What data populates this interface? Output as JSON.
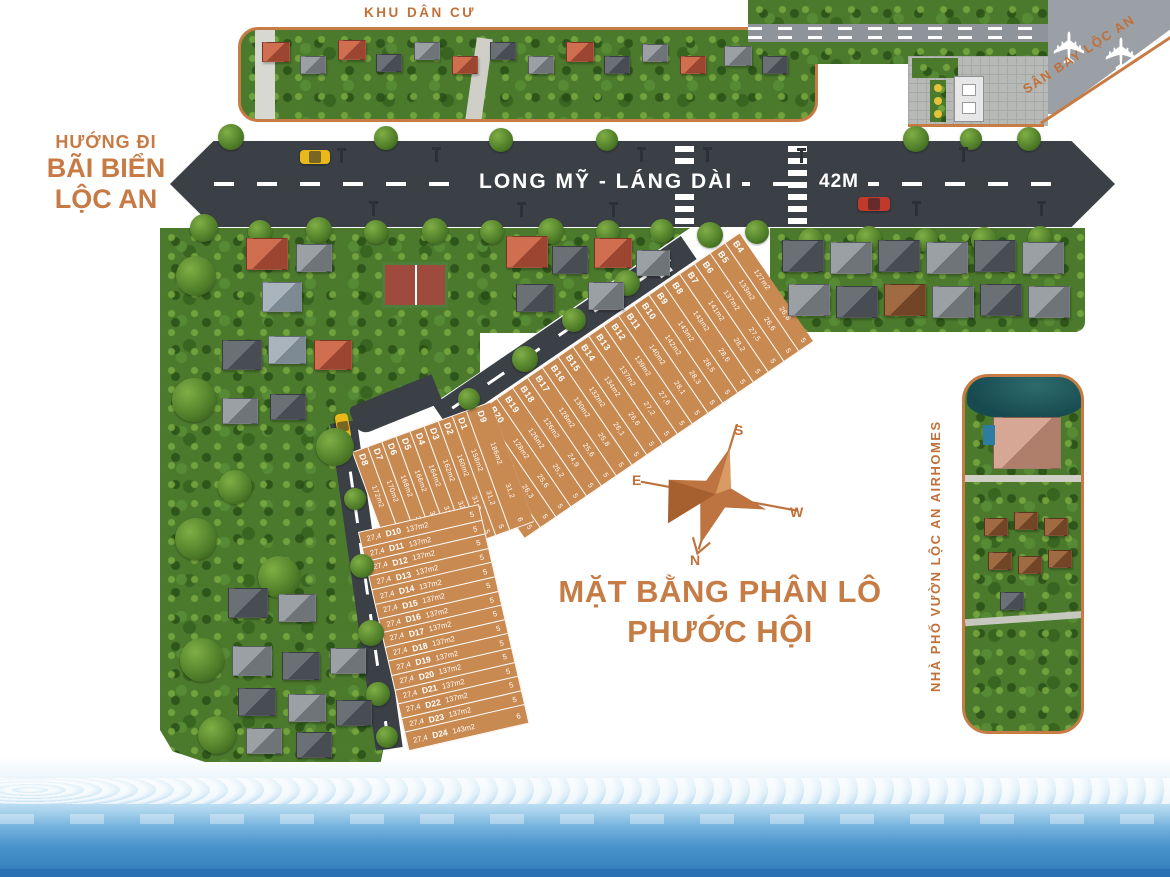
{
  "title": {
    "line1": "MẶT BẰNG PHÂN LÔ",
    "line2": "PHƯỚC HỘI"
  },
  "labels": {
    "residential_area": "KHU DÂN CƯ",
    "direction_line1": "HƯỚNG ĐI",
    "direction_line2": "BÃI BIỂN",
    "direction_line3": "LỘC AN",
    "main_road_name": "LONG MỸ - LÁNG DÀI",
    "main_road_width": "42M",
    "airport": "SÂN BAY LỘC AN",
    "airhomes_panel": "NHÀ PHỐ VƯỜN LỘC AN AIRHOMES"
  },
  "compass": {
    "north": "N",
    "south": "S",
    "east": "E",
    "west": "W"
  },
  "colors": {
    "accent_orange": "#c67c44",
    "plot_fill": "#c98a52",
    "road_gray": "#3b4046",
    "land_green": "#4c7a2d",
    "ocean_blue": "#3a86c1"
  },
  "plots": {
    "b_series": [
      {
        "id": "B4",
        "area": "127m2",
        "depth": "26,8",
        "width": "5"
      },
      {
        "id": "B5",
        "area": "133m2",
        "depth": "26,6",
        "width": "5"
      },
      {
        "id": "B6",
        "area": "137m2",
        "depth": "27,5",
        "width": "5"
      },
      {
        "id": "B7",
        "area": "141m2",
        "depth": "28,2",
        "width": "5"
      },
      {
        "id": "B8",
        "area": "143m2",
        "depth": "28,6",
        "width": "5"
      },
      {
        "id": "B9",
        "area": "143m2",
        "depth": "28,5",
        "width": "5"
      },
      {
        "id": "B10",
        "area": "142m2",
        "depth": "28,3",
        "width": "5"
      },
      {
        "id": "B11",
        "area": "140m2",
        "depth": "28,1",
        "width": "5"
      },
      {
        "id": "B12",
        "area": "139m2",
        "depth": "27,6",
        "width": "5"
      },
      {
        "id": "B13",
        "area": "137m2",
        "depth": "27,2",
        "width": "5"
      },
      {
        "id": "B14",
        "area": "134m2",
        "depth": "26,6",
        "width": "5"
      },
      {
        "id": "B15",
        "area": "132m2",
        "depth": "26,1",
        "width": "5"
      },
      {
        "id": "B16",
        "area": "130m2",
        "depth": "25,8",
        "width": "5"
      },
      {
        "id": "B17",
        "area": "128m2",
        "depth": "25,6",
        "width": "5"
      },
      {
        "id": "B18",
        "area": "126m2",
        "depth": "24,9",
        "width": "5"
      },
      {
        "id": "B19",
        "area": "126m2",
        "depth": "25,2",
        "width": "5"
      },
      {
        "id": "B20",
        "area": "128m2",
        "depth": "25,6",
        "width": "5"
      },
      {
        "id": "B21",
        "area": "130m2",
        "depth": "26,3",
        "width": "5"
      },
      {
        "id": "B22",
        "area": "133m2",
        "depth": "26,6",
        "width": "5"
      }
    ],
    "d_diagonal": [
      {
        "id": "D1",
        "area": "158m2",
        "depth": "31,2",
        "width": "5"
      },
      {
        "id": "D2",
        "area": "160m2",
        "depth": "31,8",
        "width": "5"
      },
      {
        "id": "D3",
        "area": "162m2",
        "depth": "32,4",
        "width": "5"
      },
      {
        "id": "D4",
        "area": "164m2",
        "depth": "32,8",
        "width": "5"
      },
      {
        "id": "D5",
        "area": "166m2",
        "depth": "33,3",
        "width": "5"
      },
      {
        "id": "D6",
        "area": "168m2",
        "depth": "34,0",
        "width": "5"
      },
      {
        "id": "D7",
        "area": "170m2",
        "depth": "34,4",
        "width": "5"
      },
      {
        "id": "D8",
        "area": "172m2",
        "depth": "34,5",
        "width": "5"
      }
    ],
    "d_corner": {
      "id": "D9",
      "area": "186m2",
      "depth": "31,2",
      "width": "6"
    },
    "d_vertical": [
      {
        "id": "D10",
        "area": "137m2",
        "depth": "27,4",
        "width": "5"
      },
      {
        "id": "D11",
        "area": "137m2",
        "depth": "27,4",
        "width": "5"
      },
      {
        "id": "D12",
        "area": "137m2",
        "depth": "27,4",
        "width": "5"
      },
      {
        "id": "D13",
        "area": "137m2",
        "depth": "27,4",
        "width": "5"
      },
      {
        "id": "D14",
        "area": "137m2",
        "depth": "27,4",
        "width": "5"
      },
      {
        "id": "D15",
        "area": "137m2",
        "depth": "27,4",
        "width": "5"
      },
      {
        "id": "D16",
        "area": "137m2",
        "depth": "27,4",
        "width": "5"
      },
      {
        "id": "D17",
        "area": "137m2",
        "depth": "27,4",
        "width": "5"
      },
      {
        "id": "D18",
        "area": "137m2",
        "depth": "27,4",
        "width": "5"
      },
      {
        "id": "D19",
        "area": "137m2",
        "depth": "27,4",
        "width": "5"
      },
      {
        "id": "D20",
        "area": "137m2",
        "depth": "27,4",
        "width": "5"
      },
      {
        "id": "D21",
        "area": "137m2",
        "depth": "27,4",
        "width": "5"
      },
      {
        "id": "D22",
        "area": "137m2",
        "depth": "27,4",
        "width": "5"
      },
      {
        "id": "D23",
        "area": "137m2",
        "depth": "27,4",
        "width": "5"
      },
      {
        "id": "D24",
        "area": "143m2",
        "depth": "27,4",
        "width": "6"
      }
    ]
  }
}
